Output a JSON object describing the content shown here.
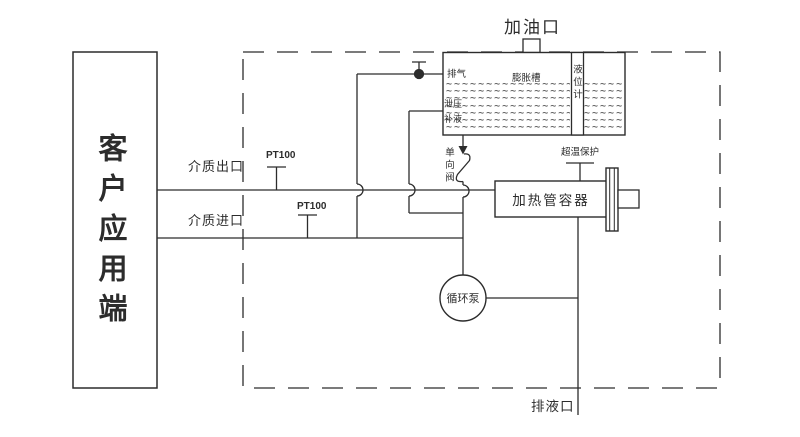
{
  "diagram": {
    "title_hint": "加热循环系统原理图",
    "customer_box": {
      "label": "客户应用端"
    },
    "ports": {
      "fill_port": "加油口",
      "drain_port": "排液口",
      "medium_outlet": "介质出口",
      "medium_inlet": "介质进口"
    },
    "tank": {
      "name": "膨胀槽",
      "vent": "排气",
      "level_gauge": "液位计",
      "relief": "泄压",
      "makeup": "补液",
      "hatch_block": "~~~~~~~~~~~~~~~~~~~~\n~~~~~~~~~~~~~~~~~~~~\n~~~~~~~~~~~~~~~~~~~~\n~~~~~~~~~~~~~~~~~~~~\n~~~~~~~~~~~~~~~~~~~~\n~~~~~~~~~~~~~~~~~~~~\n~~~~~~~~~~~~~~~~~~~~"
    },
    "valves": {
      "check_valve": "单向阀",
      "vent_valve": "排气阀"
    },
    "sensors": {
      "pt100_outlet": "PT100",
      "pt100_inlet": "PT100",
      "overtemp": "超温保护"
    },
    "equipment": {
      "heater": "加热管容器",
      "pump": "循环泵"
    },
    "colors": {
      "line": "#2c2c2c",
      "background": "#ffffff"
    }
  }
}
